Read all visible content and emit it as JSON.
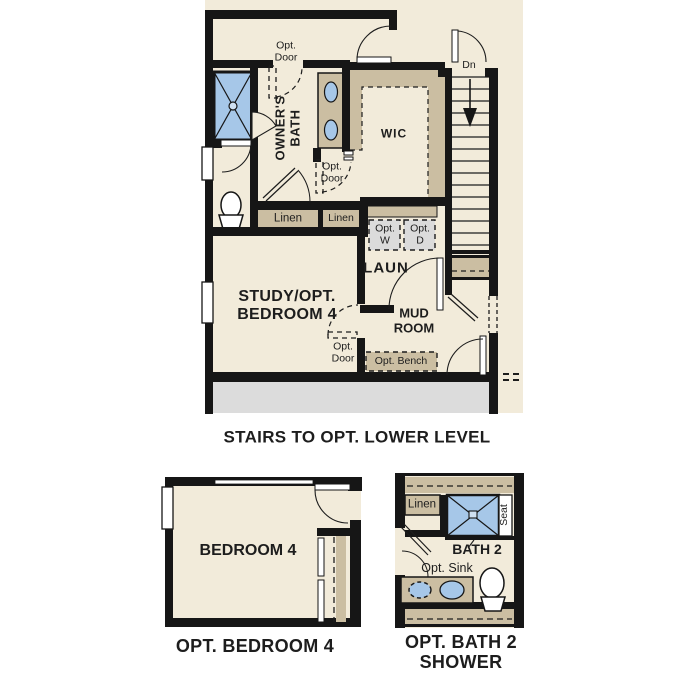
{
  "colors": {
    "background": "#ffffff",
    "floor_cream": "#f2ebda",
    "wall_black": "#161616",
    "closet_tan": "#cbbea2",
    "fixture_blue": "#a6c7e8",
    "porch_gray": "#dcdcdc",
    "appliance_gray": "#dbdbdb",
    "text": "#1d1d1d"
  },
  "main_plan": {
    "caption": "STAIRS TO OPT. LOWER LEVEL",
    "labels": {
      "opt_door_top": "Opt.\nDoor",
      "dn": "Dn",
      "owners_bath": "OWNER'S\nBATH",
      "wic": "WIC",
      "linen_left": "Linen",
      "linen_right": "Linen",
      "opt_washer": "Opt.\nW",
      "opt_dryer": "Opt.\nD",
      "opt_door_wic": "Opt.\nDoor",
      "laundry": "LAUN",
      "study": "STUDY/OPT.\nBEDROOM 4",
      "mud_room": "MUD\nROOM",
      "opt_door_study": "Opt.\nDoor",
      "opt_bench": "Opt. Bench"
    }
  },
  "bedroom_plan": {
    "room_label": "BEDROOM 4",
    "caption": "OPT. BEDROOM 4"
  },
  "bath_plan": {
    "labels": {
      "linen": "Linen",
      "seat": "Seat",
      "bath": "BATH 2",
      "opt_sink": "Opt. Sink"
    },
    "caption": "OPT. BATH 2\nSHOWER"
  }
}
